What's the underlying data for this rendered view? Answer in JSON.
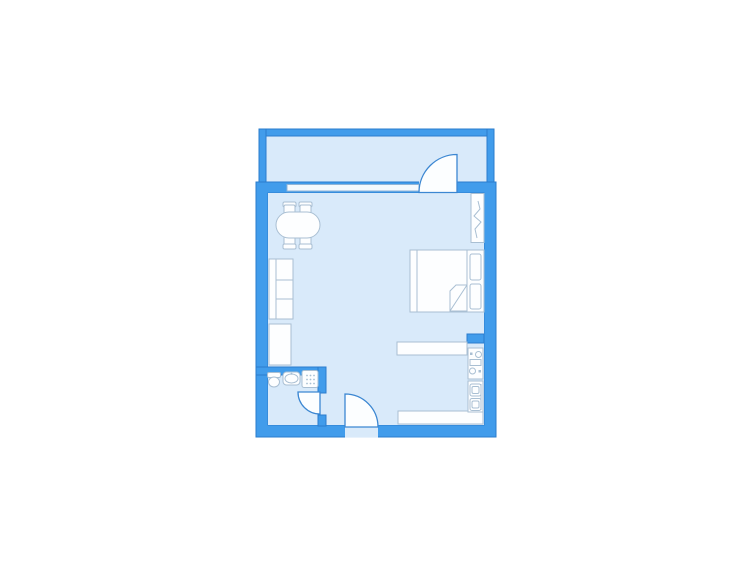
{
  "colors": {
    "background": "#ffffff",
    "wall": "#419ceb",
    "wall_edge": "#2a7ccd",
    "floor": "#d9eafa",
    "furniture_fill": "#fdfeff",
    "furniture_stroke": "#a9bfd3",
    "door_fill": "#fcfeff",
    "door_stroke": "#3c87d2",
    "window_fill": "#f4f9fd",
    "window_stroke": "#90b4d6"
  },
  "floorplan": {
    "type": "apartment-floor-plan",
    "rooms": [
      {
        "name": "balcony"
      },
      {
        "name": "main-room"
      },
      {
        "name": "bathroom"
      },
      {
        "name": "kitchen-area"
      }
    ],
    "openings": [
      {
        "name": "balcony-window"
      },
      {
        "name": "balcony-door"
      },
      {
        "name": "bathroom-door"
      },
      {
        "name": "entrance-door"
      }
    ],
    "furniture": [
      {
        "name": "dining-table"
      },
      {
        "name": "dining-chairs",
        "count": 4
      },
      {
        "name": "bookshelf"
      },
      {
        "name": "wardrobe"
      },
      {
        "name": "double-bed"
      },
      {
        "name": "pillows",
        "count": 2
      },
      {
        "name": "radiator"
      },
      {
        "name": "kitchen-counter"
      },
      {
        "name": "stove"
      },
      {
        "name": "kitchen-sink"
      },
      {
        "name": "worktop"
      },
      {
        "name": "toilet"
      },
      {
        "name": "washbasin"
      },
      {
        "name": "shower-tray"
      }
    ]
  }
}
